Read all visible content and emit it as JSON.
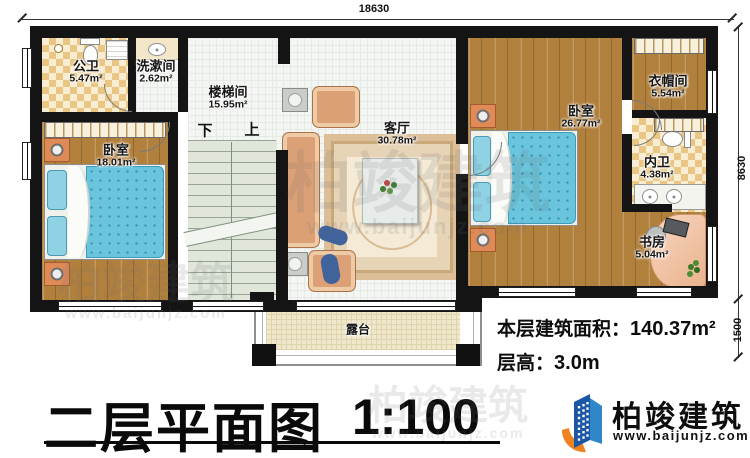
{
  "plan": {
    "dimensions": {
      "top": "18630",
      "right_upper": "8630",
      "right_lower": "1500"
    },
    "rooms": [
      {
        "name": "公卫",
        "area": "5.47m²"
      },
      {
        "name": "洗漱间",
        "area": "2.62m²"
      },
      {
        "name": "楼梯间",
        "area": "15.95m²"
      },
      {
        "name": "卧室",
        "area": "18.01m²"
      },
      {
        "name": "客厅",
        "area": "30.78m²"
      },
      {
        "name": "卧室",
        "area": "26.77m²"
      },
      {
        "name": "衣帽间",
        "area": "5.54m²"
      },
      {
        "name": "内卫",
        "area": "4.38m²"
      },
      {
        "name": "书房",
        "area": "5.04m²"
      },
      {
        "name": "露台",
        "area": ""
      }
    ],
    "stairs": {
      "down_label": "下",
      "up_label": "上"
    }
  },
  "annotations": {
    "floor_area_label": "本层建筑面积：",
    "floor_area_value": "140.37m²",
    "floor_height_label": "层高：",
    "floor_height_value": "3.0m"
  },
  "title": {
    "text": "二层平面图",
    "scale": "1:100"
  },
  "brand": {
    "name": "柏竣建筑",
    "website": "www.baijunjz.com"
  },
  "watermark": {
    "text": "柏竣建筑",
    "url": "www.baijunjz.com"
  },
  "colors": {
    "wall": "#141414",
    "wood_floor": "#b2803d",
    "checker_tile": "#e9c684",
    "white_tile": "#f4f6f3",
    "stairs": "#e0e7da",
    "terrace": "#efe7ca",
    "bed_blue": "#69c4dc",
    "brand_blue": "#1c57a5",
    "brand_orange": "#ef8220"
  }
}
